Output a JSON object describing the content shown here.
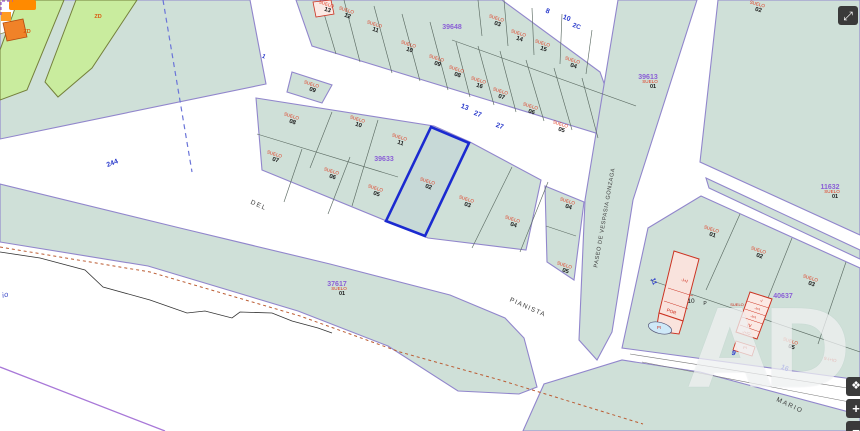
{
  "map": {
    "title": "cadastral-parcel-map",
    "watermark": "AD",
    "controls": {
      "fullscreen_icon": "⤢",
      "pan_icon": "❖",
      "zoom_in": "+",
      "zoom_out": "−"
    },
    "colors": {
      "parcel_fill": "#cfe0d8",
      "parcel_edge": "#9186cc",
      "inner_line": "#5c6b63",
      "green_zone": "#c9ec9e",
      "suelo_red": "#e03a1e",
      "block_id_purple": "#8a5fd6",
      "street_number_blue": "#2b3ccc",
      "highlight_blue": "#1b2ad0",
      "building_pink": "#fbe9e4",
      "building_red": "#cc3322",
      "orange_building": "#f08228",
      "pond_blue": "#cfe9f8"
    },
    "street_names": [
      {
        "text": "DEL",
        "x": 258,
        "y": 207,
        "rot": 24,
        "size": 6.5,
        "spacing": 1.5,
        "color": "#3c3c3c",
        "italic": false
      },
      {
        "text": "PIANISTA",
        "x": 527,
        "y": 309,
        "rot": 24,
        "size": 6.5,
        "spacing": 1.2,
        "color": "#3c3c3c",
        "italic": false
      },
      {
        "text": "MARIO",
        "x": 789,
        "y": 407,
        "rot": 25,
        "size": 6.5,
        "spacing": 1.5,
        "color": "#3c3c3c",
        "italic": false
      },
      {
        "text": "PASEO DE VESPASIA GONZAGA",
        "x": 606,
        "y": 218,
        "rot": -80,
        "size": 5.6,
        "spacing": 0.6,
        "color": "#3c3c3c",
        "italic": false
      },
      {
        "text": "io",
        "x": 6,
        "y": 297,
        "rot": -15,
        "size": 7.5,
        "spacing": 0.5,
        "color": "#3a48c8",
        "italic": true
      }
    ],
    "street_numbers": [
      {
        "text": "244",
        "x": 113,
        "y": 165,
        "rot": -21,
        "size": 7
      },
      {
        "text": "13",
        "x": 464,
        "y": 109,
        "rot": 20,
        "size": 7
      },
      {
        "text": "27",
        "x": 477,
        "y": 116,
        "rot": 20,
        "size": 7
      },
      {
        "text": "27",
        "x": 499,
        "y": 128,
        "rot": 20,
        "size": 7
      },
      {
        "text": "8",
        "x": 547,
        "y": 13,
        "rot": 20,
        "size": 7
      },
      {
        "text": "10",
        "x": 566,
        "y": 20,
        "rot": 20,
        "size": 7
      },
      {
        "text": "2C",
        "x": 576,
        "y": 28,
        "rot": 20,
        "size": 6.5
      },
      {
        "text": "1",
        "x": 263,
        "y": 58,
        "rot": 25,
        "size": 6
      },
      {
        "text": "11",
        "x": 652,
        "y": 282,
        "rot": 70,
        "size": 6.5
      },
      {
        "text": "9",
        "x": 733,
        "y": 355,
        "rot": 20,
        "size": 7
      },
      {
        "text": "16",
        "x": 784,
        "y": 370,
        "rot": 22,
        "size": 7
      }
    ],
    "block_ids": [
      {
        "id": "39648",
        "x": 452,
        "y": 29,
        "suelo": false,
        "num": ""
      },
      {
        "id": "39633",
        "x": 384,
        "y": 161,
        "suelo": false,
        "num": ""
      },
      {
        "id": "39613",
        "x": 648,
        "y": 79,
        "suelo": true,
        "num": "01"
      },
      {
        "id": "37617",
        "x": 337,
        "y": 286,
        "suelo": true,
        "num": "01"
      },
      {
        "id": "40637",
        "x": 783,
        "y": 298,
        "suelo": false,
        "num": ""
      },
      {
        "id": "11632",
        "x": 830,
        "y": 189,
        "suelo": true,
        "num": "01"
      }
    ],
    "parcels": [
      {
        "n": "13",
        "x": 326,
        "y": 7,
        "rot": 18
      },
      {
        "n": "12",
        "x": 346,
        "y": 13,
        "rot": 18
      },
      {
        "n": "11",
        "x": 374,
        "y": 27,
        "rot": 18
      },
      {
        "n": "10",
        "x": 408,
        "y": 47,
        "rot": 18
      },
      {
        "n": "09",
        "x": 436,
        "y": 61,
        "rot": 18
      },
      {
        "n": "08",
        "x": 456,
        "y": 72,
        "rot": 18
      },
      {
        "n": "16",
        "x": 478,
        "y": 83,
        "rot": 18
      },
      {
        "n": "07",
        "x": 500,
        "y": 94,
        "rot": 18
      },
      {
        "n": "06",
        "x": 530,
        "y": 109,
        "rot": 18
      },
      {
        "n": "05",
        "x": 560,
        "y": 127,
        "rot": 18
      },
      {
        "n": "03",
        "x": 496,
        "y": 21,
        "rot": 18
      },
      {
        "n": "14",
        "x": 518,
        "y": 36,
        "rot": 18
      },
      {
        "n": "15",
        "x": 542,
        "y": 46,
        "rot": 18
      },
      {
        "n": "04",
        "x": 572,
        "y": 63,
        "rot": 18
      },
      {
        "n": "09",
        "x": 311,
        "y": 87,
        "rot": 18
      },
      {
        "n": "08",
        "x": 291,
        "y": 119,
        "rot": 18
      },
      {
        "n": "10",
        "x": 357,
        "y": 122,
        "rot": 18
      },
      {
        "n": "11",
        "x": 399,
        "y": 140,
        "rot": 18
      },
      {
        "n": "07",
        "x": 274,
        "y": 157,
        "rot": 18
      },
      {
        "n": "06",
        "x": 331,
        "y": 174,
        "rot": 18
      },
      {
        "n": "05",
        "x": 375,
        "y": 191,
        "rot": 18
      },
      {
        "n": "02",
        "x": 427,
        "y": 184,
        "rot": 18
      },
      {
        "n": "03",
        "x": 466,
        "y": 202,
        "rot": 18
      },
      {
        "n": "04",
        "x": 512,
        "y": 222,
        "rot": 18
      },
      {
        "n": "04",
        "x": 567,
        "y": 204,
        "rot": 18
      },
      {
        "n": "05",
        "x": 564,
        "y": 268,
        "rot": 18
      },
      {
        "n": "02",
        "x": 757,
        "y": 7,
        "rot": 15
      },
      {
        "n": "01",
        "x": 711,
        "y": 232,
        "rot": 18
      },
      {
        "n": "02",
        "x": 758,
        "y": 253,
        "rot": 18
      },
      {
        "n": "03",
        "x": 810,
        "y": 281,
        "rot": 18
      },
      {
        "n": "05",
        "x": 790,
        "y": 344,
        "rot": 18
      }
    ],
    "zone_labels": [
      {
        "text": "ZD",
        "x": 27,
        "y": 33
      },
      {
        "text": "ZD",
        "x": 98,
        "y": 18
      }
    ],
    "building_labels": [
      {
        "text": "-I+I",
        "x": 684,
        "y": 282,
        "rot": 18,
        "size": 4.6,
        "color": "#cc2211"
      },
      {
        "text": "POR",
        "x": 671,
        "y": 313,
        "rot": 20,
        "size": 4.6,
        "color": "#cc2211"
      },
      {
        "text": "PI",
        "x": 659,
        "y": 329,
        "rot": 0,
        "size": 4.2,
        "color": "#cc2211"
      },
      {
        "text": "10",
        "x": 691,
        "y": 303,
        "rot": 0,
        "size": 6.5,
        "color": "#1a1a1a"
      },
      {
        "text": "P",
        "x": 705,
        "y": 305,
        "rot": 0,
        "size": 5,
        "color": "#1a1a1a"
      },
      {
        "text": "SUELO",
        "x": 737,
        "y": 306,
        "rot": 0,
        "size": 4.0,
        "color": "#cc2211"
      },
      {
        "text": "-I",
        "x": 761,
        "y": 302,
        "rot": 15,
        "size": 3.8,
        "color": "#cc2211"
      },
      {
        "text": "-I+I",
        "x": 757,
        "y": 310,
        "rot": 15,
        "size": 3.8,
        "color": "#cc2211"
      },
      {
        "text": "-I+I",
        "x": 753,
        "y": 318,
        "rot": 15,
        "size": 3.8,
        "color": "#cc2211"
      },
      {
        "text": "IV",
        "x": 749,
        "y": 327,
        "rot": 15,
        "size": 4.5,
        "color": "#cc2211"
      },
      {
        "text": "-I+IO",
        "x": 746,
        "y": 334,
        "rot": 15,
        "size": 3.8,
        "color": "#cc2211"
      },
      {
        "text": "PI",
        "x": 745,
        "y": 349,
        "rot": 0,
        "size": 4.0,
        "color": "#cc2211"
      },
      {
        "text": "9-I+IO",
        "x": 830,
        "y": 361,
        "rot": 12,
        "size": 4.5,
        "color": "#cc2211"
      }
    ]
  }
}
